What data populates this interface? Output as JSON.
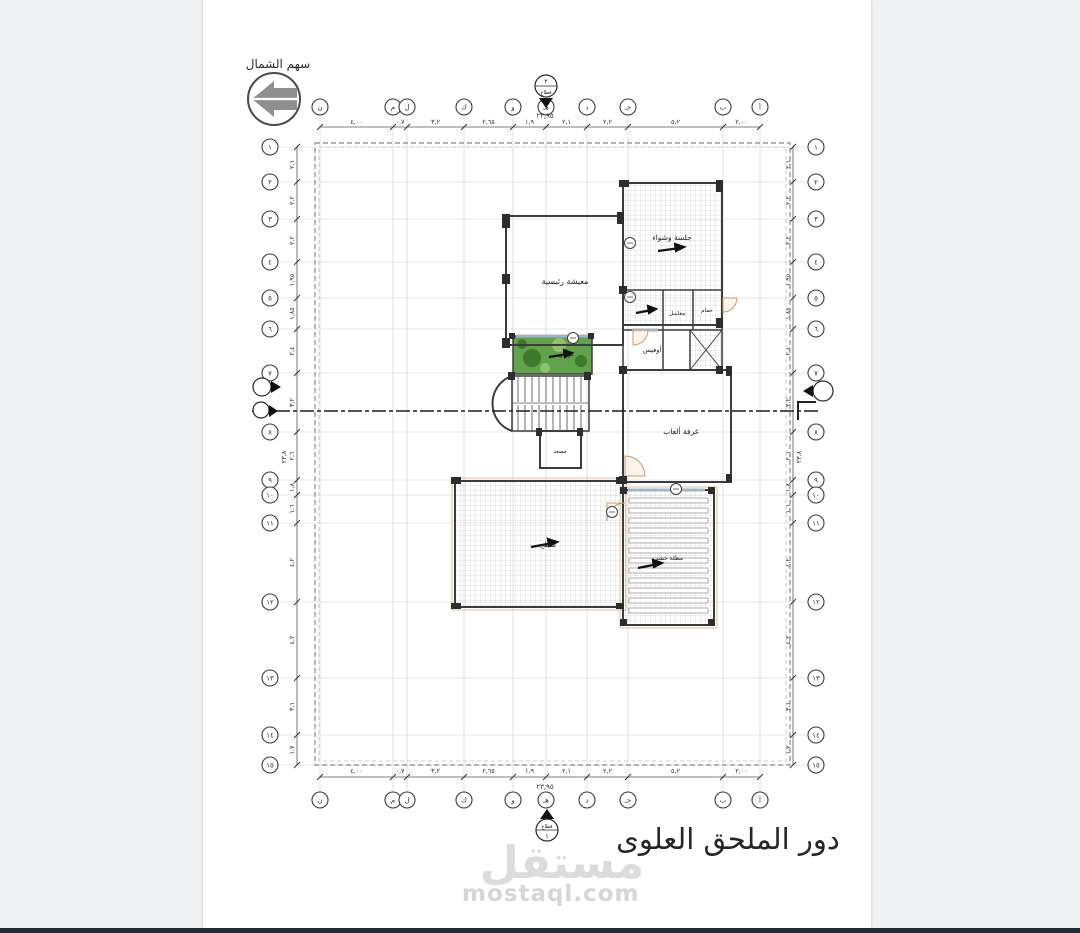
{
  "caption": "دور الملحق العلوى",
  "north_arrow": {
    "label": "سهم الشمال"
  },
  "watermark": {
    "logo": "مستقل",
    "url": "mostaql.com"
  },
  "section_markers": {
    "top": {
      "number": "٢",
      "word": "قطاع"
    },
    "bottom": {
      "word": "قطاع",
      "number": "١"
    }
  },
  "rooms": {
    "living": {
      "label": "معيشة رئيسية"
    },
    "bbq": {
      "label": "جلسة وشواء"
    },
    "sinks": {
      "label": "مغاسل"
    },
    "bath": {
      "label": "حمام"
    },
    "office": {
      "label": "أوفيس"
    },
    "games": {
      "label": "غرفة ألعاب"
    },
    "terrace": {
      "label": "تراس"
    },
    "roof": {
      "label": "سطح"
    },
    "pergola": {
      "label": "مظلة خشب"
    },
    "elevator": {
      "label": "مصعد"
    }
  },
  "grid": {
    "col_total": "٢٣,٩٥",
    "row_total": "٢٣,٨",
    "cols": [
      {
        "x": 320,
        "label": "ن",
        "dim": "٤,٠٠"
      },
      {
        "x": 393,
        "label": "م",
        "dim": "٠,٧"
      },
      {
        "x": 407,
        "label": "ل",
        "dim": "٣,٢"
      },
      {
        "x": 464,
        "label": "ك",
        "dim": "٢,٦٥"
      },
      {
        "x": 513,
        "label": "و",
        "dim": "١,٩"
      },
      {
        "x": 546,
        "label": "هـ",
        "dim": "٢,١"
      },
      {
        "x": 587,
        "label": "د",
        "dim": "٢,٢"
      },
      {
        "x": 628,
        "label": "جـ",
        "dim": "٥,٢"
      },
      {
        "x": 723,
        "label": "ب",
        "dim": "٢,٠٠"
      },
      {
        "x": 760,
        "label": "أ"
      }
    ],
    "rows": [
      {
        "y": 147,
        "label": "١",
        "dim": "٢,١"
      },
      {
        "y": 182,
        "label": "٢",
        "dim": "٢,٢"
      },
      {
        "y": 219,
        "label": "٣",
        "dim": "٢,٢"
      },
      {
        "y": 262,
        "label": "٤",
        "dim": "١,٩٥"
      },
      {
        "y": 298,
        "label": "٥",
        "dim": "١,٨٥"
      },
      {
        "y": 329,
        "label": "٦",
        "dim": "٢,٤"
      },
      {
        "y": 373,
        "label": "٧",
        "dim": "٣,٢"
      },
      {
        "y": 432,
        "label": "٨",
        "dim": "٢,٦"
      },
      {
        "y": 480,
        "label": "٩",
        "dim": "١,٨"
      },
      {
        "y": 495,
        "label": "١٠",
        "dim": "١,٦"
      },
      {
        "y": 523,
        "label": "١١",
        "dim": "٤,٢"
      },
      {
        "y": 602,
        "label": "١٢",
        "dim": "٤,٢"
      },
      {
        "y": 678,
        "label": "١٣",
        "dim": "٣,١"
      },
      {
        "y": 735,
        "label": "١٤",
        "dim": "١,٧"
      },
      {
        "y": 765,
        "label": "١٥"
      }
    ]
  },
  "colors": {
    "wall": "#3c3c3c",
    "light_grid": "#cfcfcf",
    "dim_text": "#333333",
    "terrace_green": "#63a24c",
    "plant_dark": "#3e7a2d",
    "plant_light": "#90c172",
    "sill_blue": "#9fb6c9",
    "door_tan": "#c99b6f",
    "slab_tan": "#d8c49c",
    "page_bg": "#f0f1f3",
    "bottom_bar": "#222a35",
    "watermark_gray": "#dcdcdd"
  }
}
